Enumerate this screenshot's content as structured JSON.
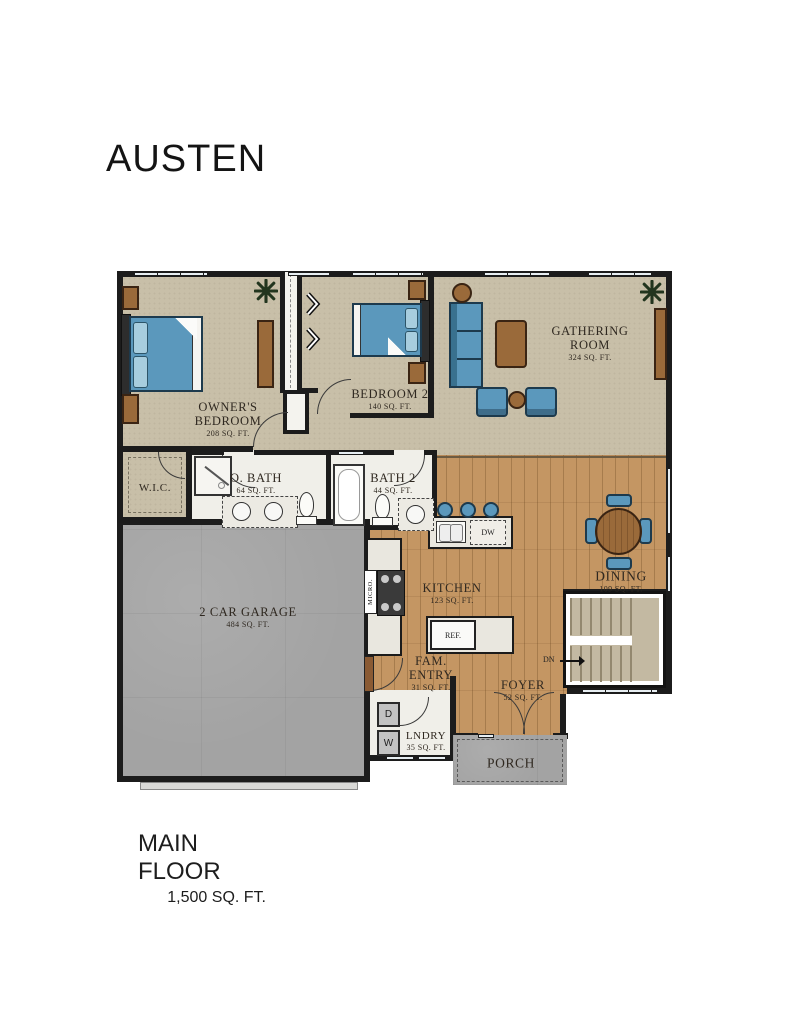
{
  "title": "AUSTEN",
  "footer": {
    "title": "MAIN FLOOR",
    "subtitle": "1,500 SQ. FT."
  },
  "rooms": {
    "gathering": {
      "name": "GATHERING ROOM",
      "area": "324 SQ. FT."
    },
    "owners": {
      "name": "OWNER'S BEDROOM",
      "area": "208 SQ. FT."
    },
    "bedroom2": {
      "name": "BEDROOM 2",
      "area": "140 SQ. FT."
    },
    "wic": {
      "name": "W.I.C."
    },
    "obath": {
      "name": "O. BATH",
      "area": "64 SQ. FT."
    },
    "bath2": {
      "name": "BATH 2",
      "area": "44 SQ. FT."
    },
    "garage": {
      "name": "2 CAR GARAGE",
      "area": "484 SQ. FT."
    },
    "kitchen": {
      "name": "KITCHEN",
      "area": "123 SQ. FT."
    },
    "dining": {
      "name": "DINING",
      "area": "109 SQ. FT."
    },
    "famentry": {
      "name": "FAM. ENTRY",
      "area": "31 SQ. FT."
    },
    "foyer": {
      "name": "FOYER",
      "area": "52 SQ. FT."
    },
    "laundry": {
      "name": "LNDRY",
      "area": "35 SQ. FT."
    },
    "porch": {
      "name": "PORCH"
    }
  },
  "fixtures": {
    "dishwasher": "DW",
    "refrigerator": "REF.",
    "microwave": "MICRO.",
    "dryer": "D",
    "washer": "W",
    "stairs_down": "DN"
  },
  "colors": {
    "carpet": "#c8bfa8",
    "wood": "#c49663",
    "concrete": "#a3a3a3",
    "tile": "#f0efe9",
    "wall": "#1c1c1c",
    "furniture_blue": "#5b98bc",
    "furniture_brown": "#9a6a3a",
    "window": "#e7eef2"
  }
}
